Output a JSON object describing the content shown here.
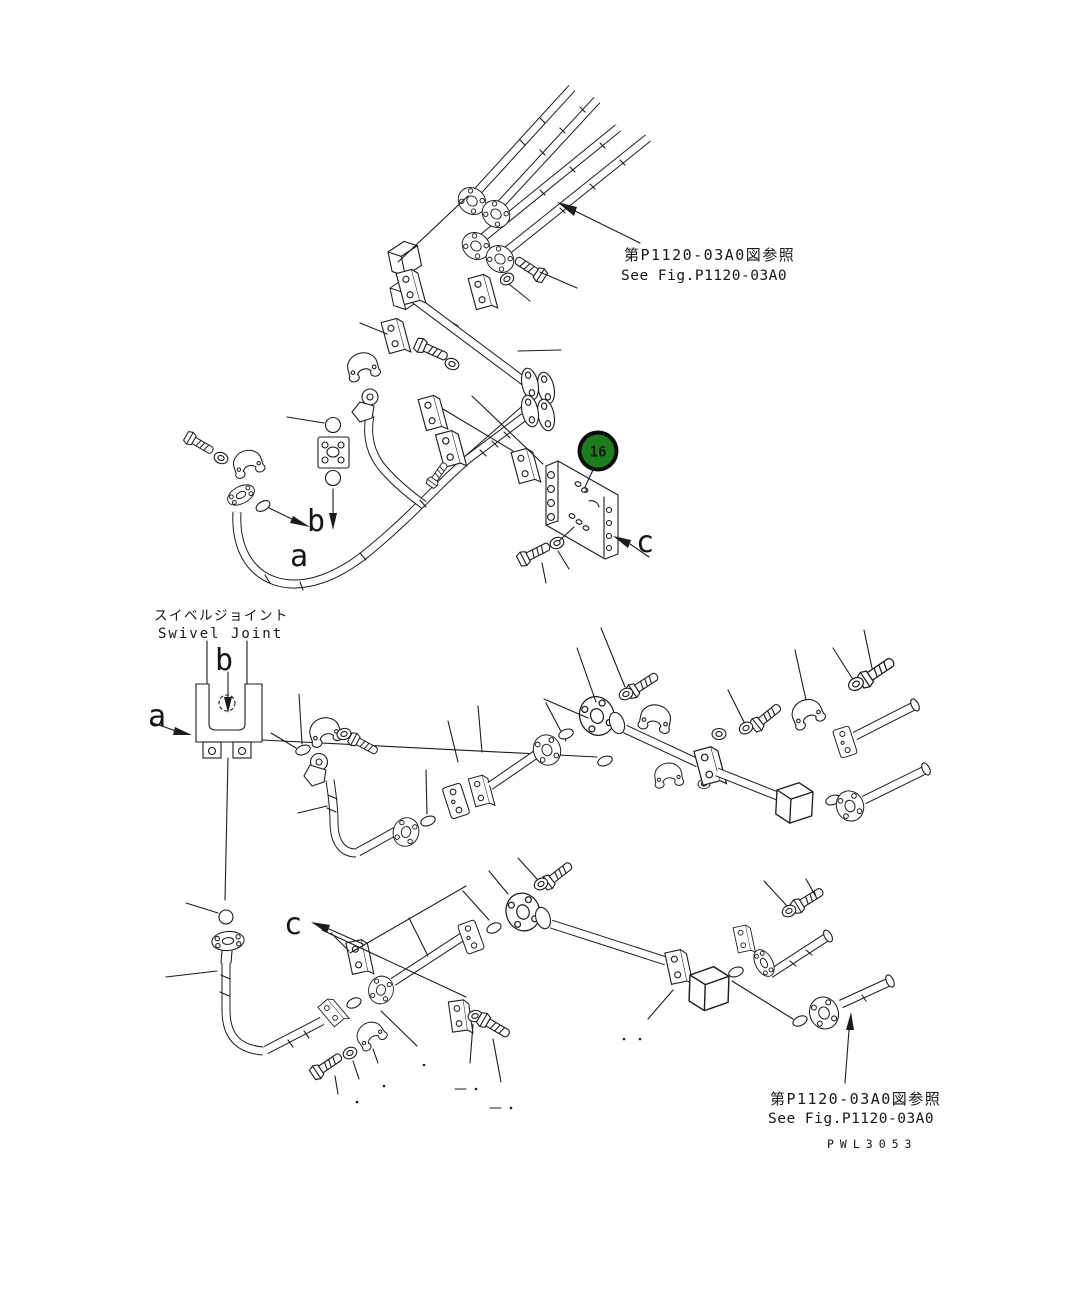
{
  "callout": {
    "number": "16"
  },
  "colors": {
    "callout_green": "#1b7d1b",
    "callout_ring": "#0d0d0d",
    "callout_text": "#ffffff"
  },
  "notes": {
    "top": {
      "jp": "第P1120-03A0図参照",
      "en": "See Fig.P1120-03A0"
    },
    "bottom": {
      "jp": "第P1120-03A0図参照",
      "en": "See Fig.P1120-03A0"
    }
  },
  "swivel_joint": {
    "label_jp": "スイベルジョイント",
    "label_en": "Swivel Joint"
  },
  "view_labels": {
    "a_top": "a",
    "b_top": "b",
    "a_swivel": "a",
    "b_swivel": "b",
    "c_plate": "c",
    "c_lower": "c"
  },
  "drawing_code": "PWL3053"
}
